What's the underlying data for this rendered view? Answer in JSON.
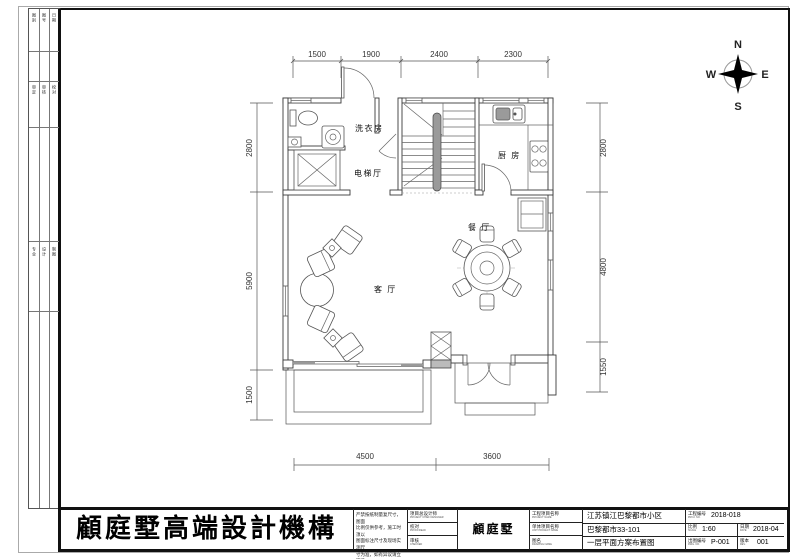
{
  "compass": {
    "n": "N",
    "s": "S",
    "e": "E",
    "w": "W"
  },
  "plan": {
    "rooms": {
      "laundry": "洗衣房",
      "elevator": "电梯厅",
      "kitchen": "厨 房",
      "dining": "餐 厅",
      "living": "客 厅"
    },
    "dims": {
      "top": [
        "1500",
        "1900",
        "2400",
        "2300"
      ],
      "left": [
        "2800",
        "5900",
        "1500"
      ],
      "right": [
        "2800",
        "4800",
        "1550"
      ],
      "bottom": [
        "4500",
        "3600"
      ]
    }
  },
  "side_strip": {
    "col_a1": "图别",
    "col_a2": "图号",
    "col_a3": "日期",
    "col_b1": "审定",
    "col_b2": "审核",
    "col_b3": "校对",
    "col_c1": "专业",
    "col_c2": "设计",
    "col_c3": "制图"
  },
  "title_block": {
    "company": "顧庭墅高端設計機構",
    "project_badge": "顧庭墅",
    "disclaimer": [
      "严禁按纸制量复尺寸，图面",
      "比例仅供参考，施工时须以",
      "图面标注尺寸及现场实测尺",
      "寸为准，如有异议请立即通",
      "知设计单位，否则后果自负"
    ],
    "sign_rows": [
      {
        "zh": "项目总设计师",
        "en": "PROJECT CHIEF DESIGNER"
      },
      {
        "zh": "校对",
        "en": "PROOFREAD"
      },
      {
        "zh": "审核",
        "en": "CHECKED"
      }
    ],
    "name_rows": [
      {
        "zh": "工程项目名称",
        "en": "PROJECT NAME"
      },
      {
        "zh": "单体项目名称",
        "en": "UNIT PROJECT NAME"
      },
      {
        "zh": "图名",
        "en": "DRAWING NAME"
      }
    ],
    "value_rows": [
      "江苏镇江巴黎都市小区",
      "巴黎都市33-101",
      "一层平面方案布置图"
    ],
    "meta": {
      "proj_no_zh": "工程编号",
      "proj_no_en": "PROJ. NO.",
      "proj_no": "2018-018",
      "scale_zh": "比例",
      "scale_en": "SCALE",
      "scale": "1:60",
      "date_zh": "日期",
      "date_en": "DATE",
      "date": "2018-04",
      "dwg_zh": "出图编号",
      "dwg_en": "DWG. NO.",
      "dwg_no": "P-001",
      "rev_zh": "版本",
      "rev_en": "REV.",
      "rev": "001"
    }
  }
}
